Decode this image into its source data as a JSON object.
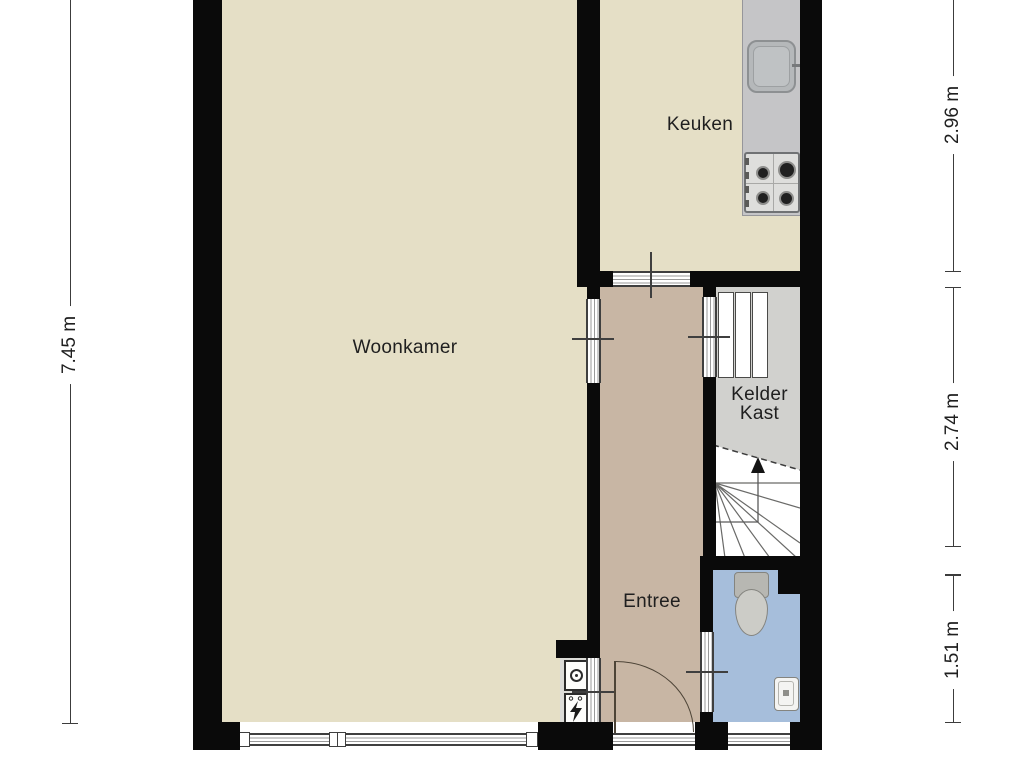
{
  "rooms": {
    "woonkamer": "Woonkamer",
    "keuken": "Keuken",
    "entree": "Entree",
    "kelder_line1": "Kelder",
    "kelder_line2": "Kast"
  },
  "dimensions": {
    "left_height": "7.45 m",
    "right_top": "2.96 m",
    "right_middle": "2.74 m",
    "right_bottom": "1.51 m"
  },
  "fixtures": [
    "kitchen-counter",
    "kitchen-sink",
    "gas-stove",
    "winder-staircase",
    "stairs-up-arrow",
    "closet-shelves",
    "toilet",
    "washbasin",
    "water-meter",
    "electricity-meter",
    "front-door",
    "windows"
  ],
  "colors": {
    "floor_living": "#e5dfc6",
    "floor_entree": "#c8b6a4",
    "floor_toilet": "#a6bedb",
    "floor_closet": "#d1d1ce",
    "counter_gray": "#c5c5c7",
    "wall_black": "#0a0a0a",
    "line_dark": "#3c3c3c"
  }
}
